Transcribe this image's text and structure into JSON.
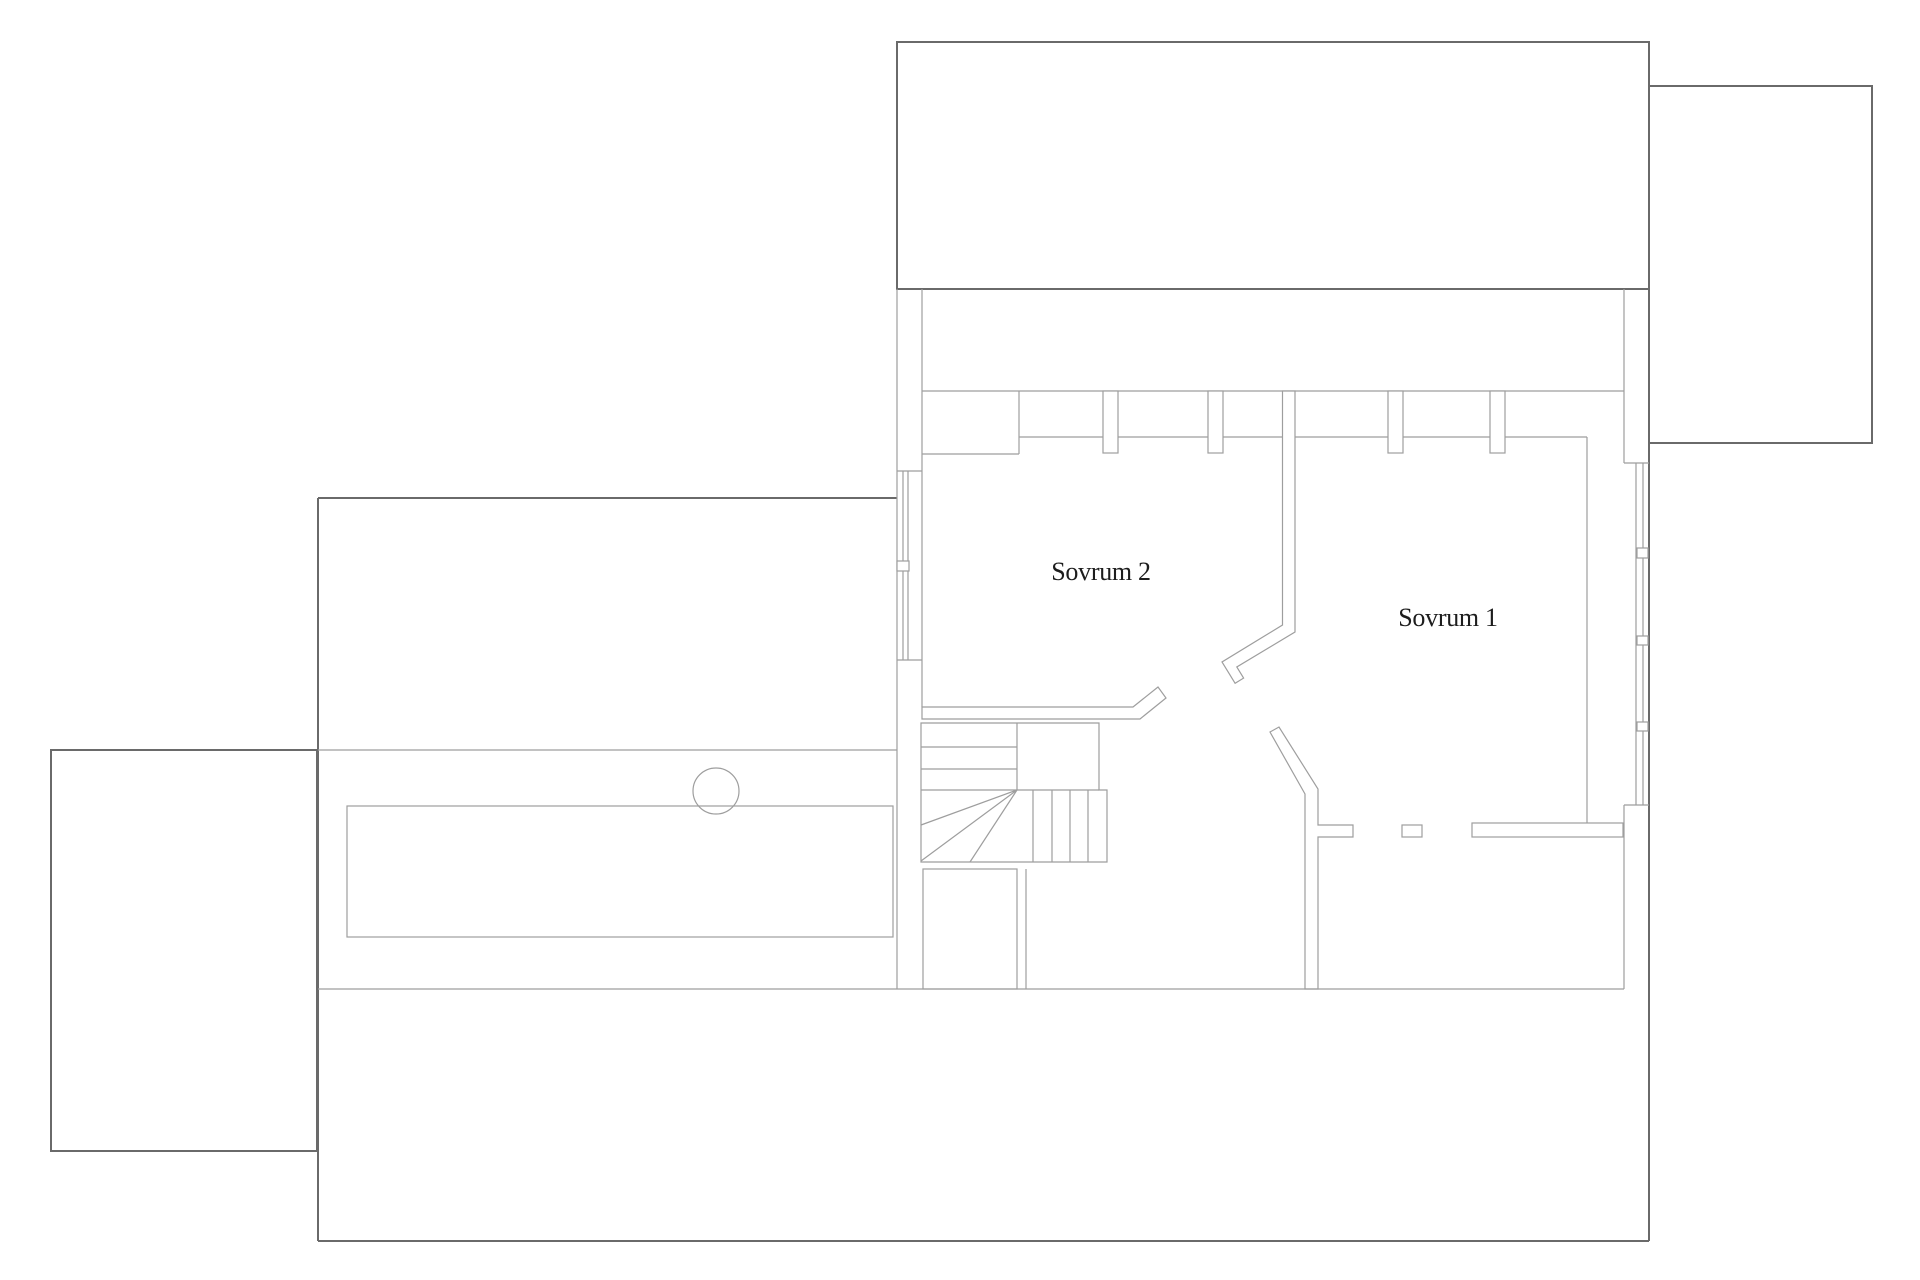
{
  "plan": {
    "type": "floor-plan",
    "rooms": [
      {
        "id": "sovrum-2",
        "label": "Sovrum 2"
      },
      {
        "id": "sovrum-1",
        "label": "Sovrum 1"
      }
    ]
  },
  "colors": {
    "outline": "#6a6a6a",
    "interior": "#9e9e9e",
    "text": "#1d1d1d",
    "background": "#ffffff"
  }
}
